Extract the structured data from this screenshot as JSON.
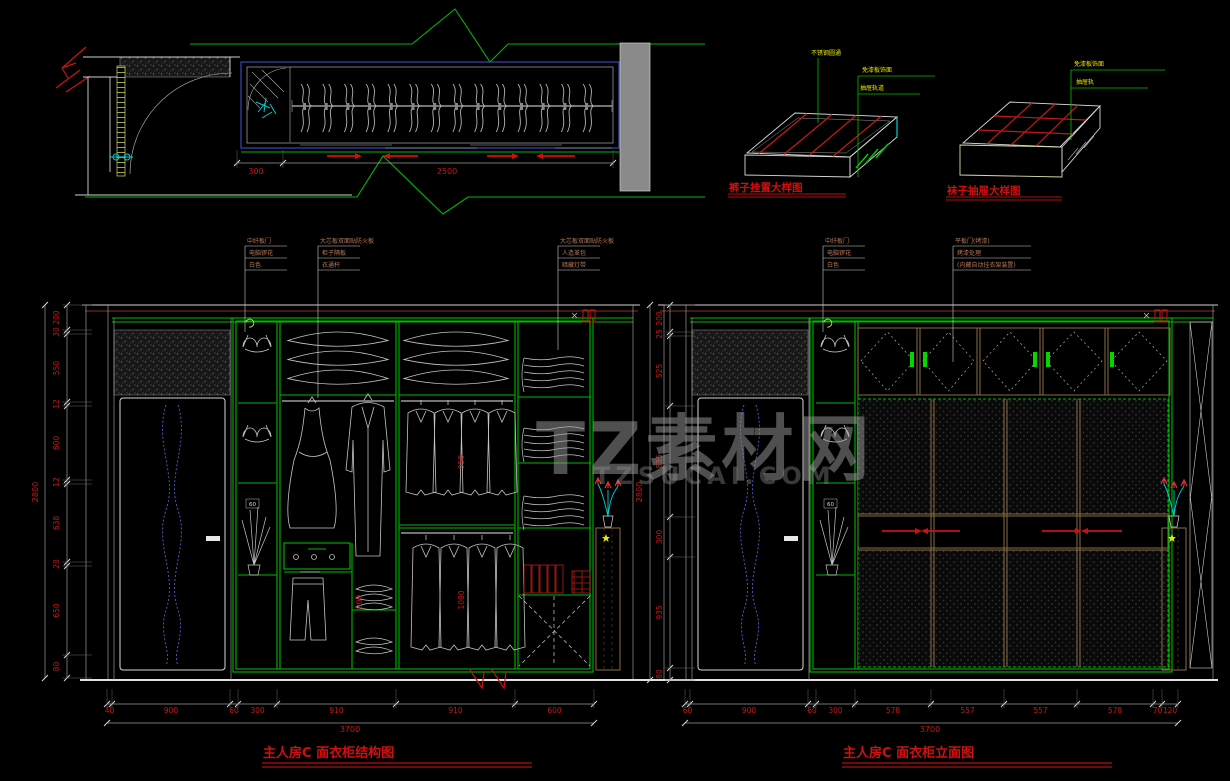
{
  "watermark": {
    "title": "TZ素材网",
    "subtitle": "TZSUCAI.COM"
  },
  "plan": {
    "width_inner": "300",
    "width_main": "2500"
  },
  "details": [
    {
      "title": "裤子挂置大样图",
      "labels": [
        "不锈钢圆通",
        "免漆板饰面",
        "抽屉轨道"
      ]
    },
    {
      "title": "袜子抽屉大样图",
      "labels": [
        "免漆板饰面",
        "抽屉轨"
      ]
    }
  ],
  "left_elevation": {
    "title": "主人房C 面衣柜结构图",
    "callouts": [
      {
        "header": "中纤板门",
        "rows": [
          "电脑锣花",
          "白色"
        ]
      },
      {
        "header": "大芯板双面贴防火板",
        "rows": [
          "柜子隔板",
          "衣通杆"
        ]
      },
      {
        "header": "大芯板双面贴防火板",
        "rows": [
          "人造革包",
          "暗藏灯带"
        ]
      }
    ],
    "overall_height": "2800",
    "height_segments": [
      "200",
      "30",
      "550",
      "12",
      "600",
      "12",
      "638",
      "20",
      "650",
      "80"
    ],
    "overall_width": "3700",
    "width_segments": [
      "40",
      "900",
      "60",
      "300",
      "910",
      "910",
      "600"
    ],
    "inner_dims": [
      "950",
      "900",
      "1080"
    ],
    "side_tag": "60"
  },
  "right_elevation": {
    "title": "主人房C 面衣柜立面图",
    "callouts": [
      {
        "header": "中纤板门",
        "rows": [
          "电脑锣花",
          "白色"
        ]
      },
      {
        "header": "平板门(烤漆)",
        "rows": [
          "烤漆处理",
          "(内藏自动挂衣架装置)"
        ]
      }
    ],
    "overall_height": "2800",
    "height_segments": [
      "200",
      "25",
      "525",
      "835",
      "300",
      "935",
      "80"
    ],
    "overall_width": "3700",
    "width_segments": [
      "60",
      "900",
      "60",
      "300",
      "578",
      "557",
      "557",
      "578",
      "70",
      "120"
    ],
    "side_tag": "60"
  },
  "colors": {
    "line_green": "#00b800",
    "dim_red": "#c81616",
    "annotation_yellow": "#e8e800",
    "cyan": "#00d2d2",
    "door_blue": "#5060d0",
    "frame_tan": "#8a6a46",
    "callout_orange": "#b87858",
    "title_red": "#d01010",
    "watermark_gray": "#9e9e9e"
  }
}
